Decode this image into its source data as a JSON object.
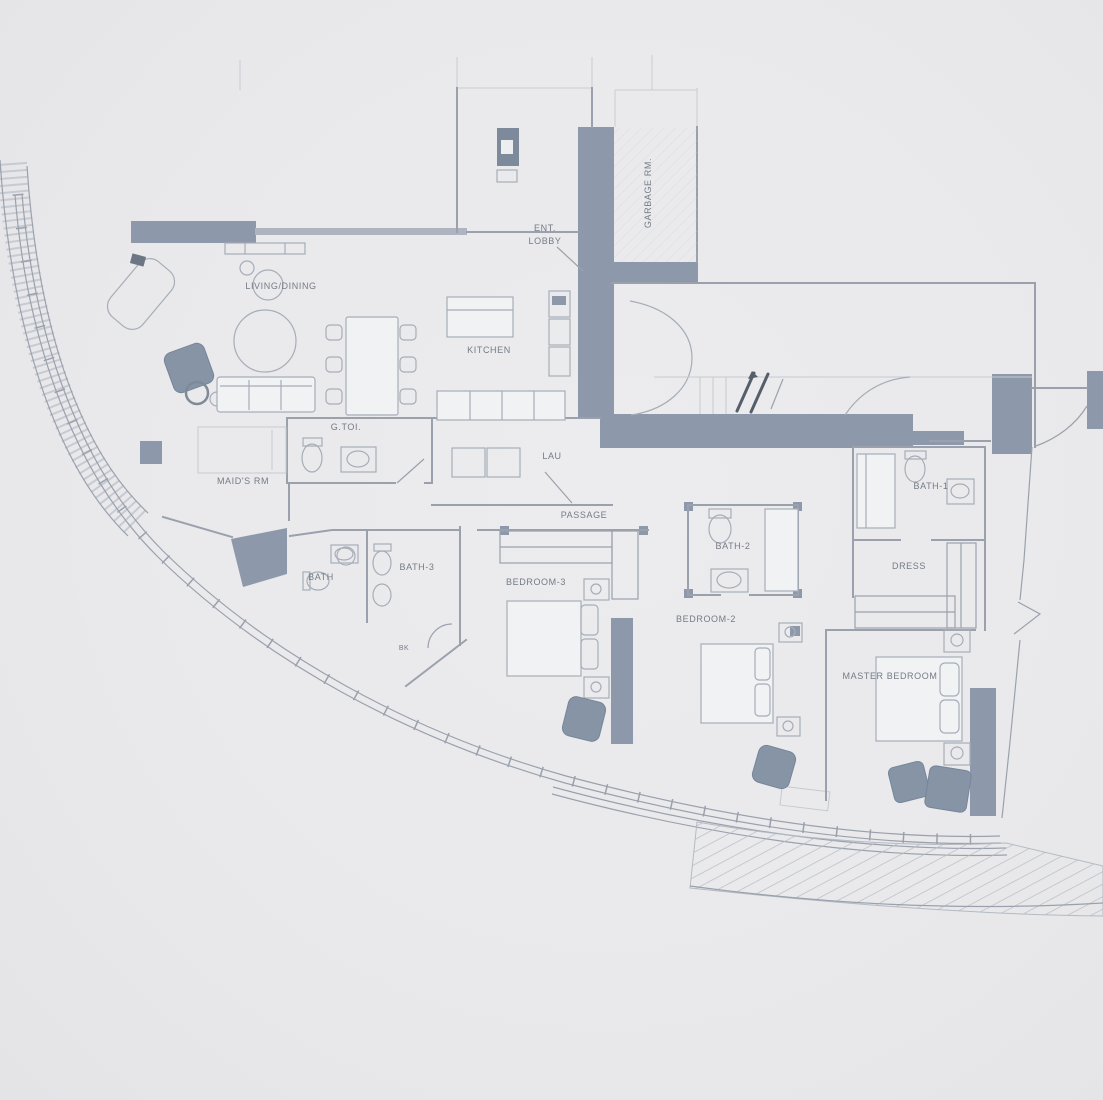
{
  "rooms": {
    "living_dining": "LIVING/DINING",
    "ent_lobby_line1": "ENT.",
    "ent_lobby_line2": "LOBBY",
    "garbage_rm": "GARBAGE RM.",
    "kitchen": "KITCHEN",
    "guest_toilet": "G.TOI.",
    "maids_rm": "MAID'S RM",
    "laundry": "LAU",
    "passage": "PASSAGE",
    "bath": "BATH",
    "bath_3": "BATH-3",
    "bedroom_3": "BEDROOM-3",
    "bath_2": "BATH-2",
    "bedroom_2": "BEDROOM-2",
    "bath_1": "BATH-1",
    "dress": "DRESS",
    "master_bedroom": "MASTER BEDROOM",
    "bk": "BK"
  },
  "colors": {
    "paper": "#e9e9eb",
    "wall": "#8d99ab",
    "furniture_dark": "#8694a6",
    "line": "#9aa1ad",
    "text": "#747b87"
  }
}
